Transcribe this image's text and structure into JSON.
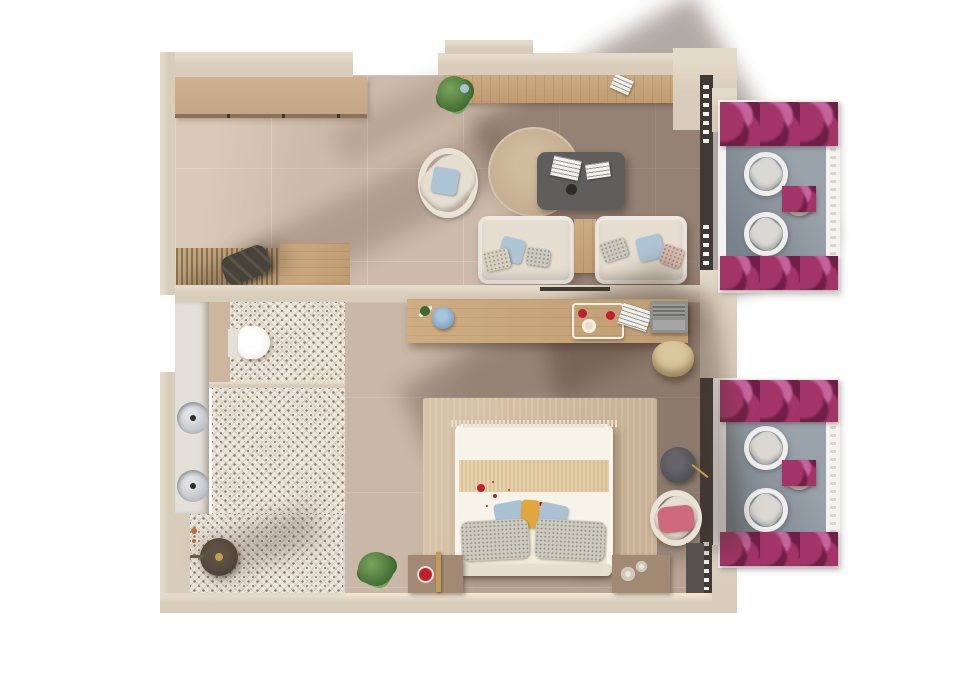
{
  "title": "apartment-floor-plan-render",
  "palette": {
    "page_bg": "#ffffff",
    "wall": "#d8ccba",
    "wall_edge": "#e4dac9",
    "living_floor": "#cdbaab",
    "living_floor_light": "#dac9b8",
    "bedroom_floor": "#b7a496",
    "bedroom_floor_light": "#c9b8a8",
    "balcony_floor": "#9aa3ab",
    "balcony_floor_shadow": "#78828c",
    "balcony_frame": "#f4f3ef",
    "railing_white": "#f6f4ef",
    "kitchen_counter": "#c4a585",
    "kitchen_counter_edge": "#8a7258",
    "wood_light": "#cfad83",
    "wood_dark": "#bf9c72",
    "mat_light": "#c2a67c",
    "mat_dark": "#8c7354",
    "bag": "#47423a",
    "rug_round": "#c3ab8c",
    "rug_round_light": "#d0bb9d",
    "coffee_table": "#5f5e5c",
    "sofa": "#e5ded1",
    "chair_cream": "#e9e3d6",
    "cushion_blue": "#aec5d6",
    "cushion_beige": "#d8d0bf",
    "paper_white": "#f2f0ea",
    "side_table": "#b98f64",
    "desk_chair": "#cdb687",
    "laptop_gray": "#8f8f8d",
    "laptop_screen": "#6f6f6e",
    "box_blue": "#7ba1c7",
    "bed_rug": "#c9b295",
    "bed_rug_light": "#d6c2a6",
    "bed_cream": "#f0ead9",
    "bed_white": "#f6f3e9",
    "bed_band": "#d9bf90",
    "pillow_gray": "#ccc9bf",
    "pillow_blue": "#a9c2d3",
    "pillow_yellow": "#dfa73e",
    "pillow_pink": "#cf6a7d",
    "petal_red": "#c0202e",
    "nightstand": "#a18974",
    "lamp_gold": "#c49b52",
    "tile_base": "#ede6da",
    "tile_motif": "#877d6f",
    "sink_counter": "#e3e0da",
    "sink_basin": "#b9bcc2",
    "toilet_white": "#f3f0e9",
    "shower_dark": "#4a4036",
    "window_dark": "#403a36",
    "wardrobe_dark": "#55524e",
    "floor_lamp": "#4b4b50",
    "plant_green_light": "#79a35c",
    "plant_green_dark": "#3e6a31",
    "flower_magenta": "#a23468",
    "flower_magenta_dark": "#6f1f46",
    "flower_pink": "#c4639c",
    "balcony_chair": "#efeeea",
    "balcony_chair_seat": "#d9d8d2",
    "balcony_table": "#b8a894",
    "led_strip": "#f7eeda",
    "shadow_tint": "#4a372b"
  },
  "scene": {
    "rooms": [
      {
        "name": "living-room",
        "furniture": [
          "kitchen-counter",
          "wall-console",
          "console-plant-left",
          "console-plant-right",
          "armchair",
          "round-rug",
          "coffee-table",
          "sofa-left",
          "sofa-right",
          "side-table",
          "entry-wood-floor",
          "entry-mat",
          "duffel-bag"
        ]
      },
      {
        "name": "bedroom",
        "furniture": [
          "writing-desk",
          "desk-chair",
          "laptop",
          "breakfast-tray",
          "blue-tin",
          "double-bed",
          "bed-rug",
          "nightstand-left",
          "nightstand-right",
          "corner-plant",
          "lounge-chair",
          "floor-lamp",
          "wardrobe"
        ]
      },
      {
        "name": "bathroom",
        "furniture": [
          "toilet",
          "vanity-counter",
          "sink-upper",
          "sink-lower",
          "shower-head",
          "patterned-tile-floor"
        ]
      },
      {
        "name": "balcony-upper",
        "furniture": [
          "outdoor-chair",
          "outdoor-chair",
          "bistro-table",
          "flowering-plants"
        ]
      },
      {
        "name": "balcony-lower",
        "furniture": [
          "outdoor-chair",
          "outdoor-chair",
          "bistro-table",
          "flowering-plants"
        ]
      }
    ]
  }
}
